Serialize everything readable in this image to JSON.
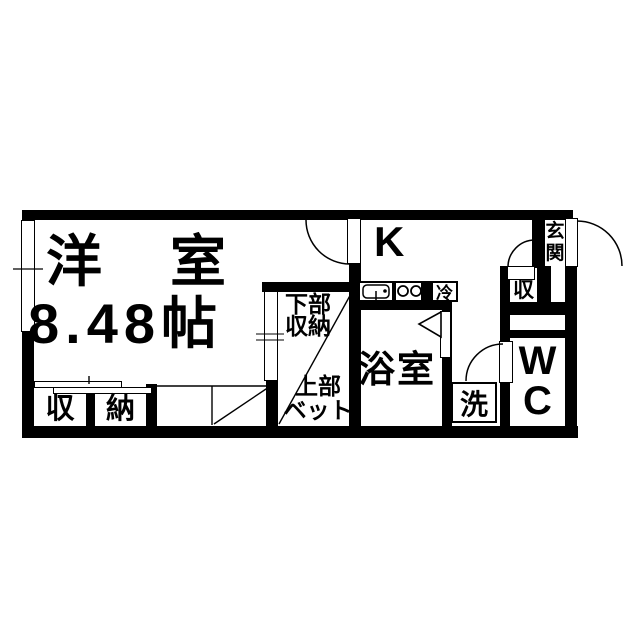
{
  "colors": {
    "wall": "#000000",
    "floor": "#ffffff",
    "line": "#000000"
  },
  "rooms": {
    "western": {
      "name": "洋　室",
      "size": "8.48帖"
    },
    "kitchen": {
      "label": "K"
    },
    "bathroom": {
      "label": "浴室"
    },
    "entrance": {
      "label": "玄\n関"
    },
    "wc": {
      "label": "W\nC"
    },
    "closet": {
      "left_cell": "収",
      "right_cell": "納"
    },
    "hall_storage": {
      "label": "収"
    },
    "bed": {
      "lower_storage": "下部\n収納",
      "upper_line1": "上部",
      "upper_line2": "ベット"
    }
  },
  "fixtures": {
    "fridge": "冷",
    "washer": "洗"
  }
}
